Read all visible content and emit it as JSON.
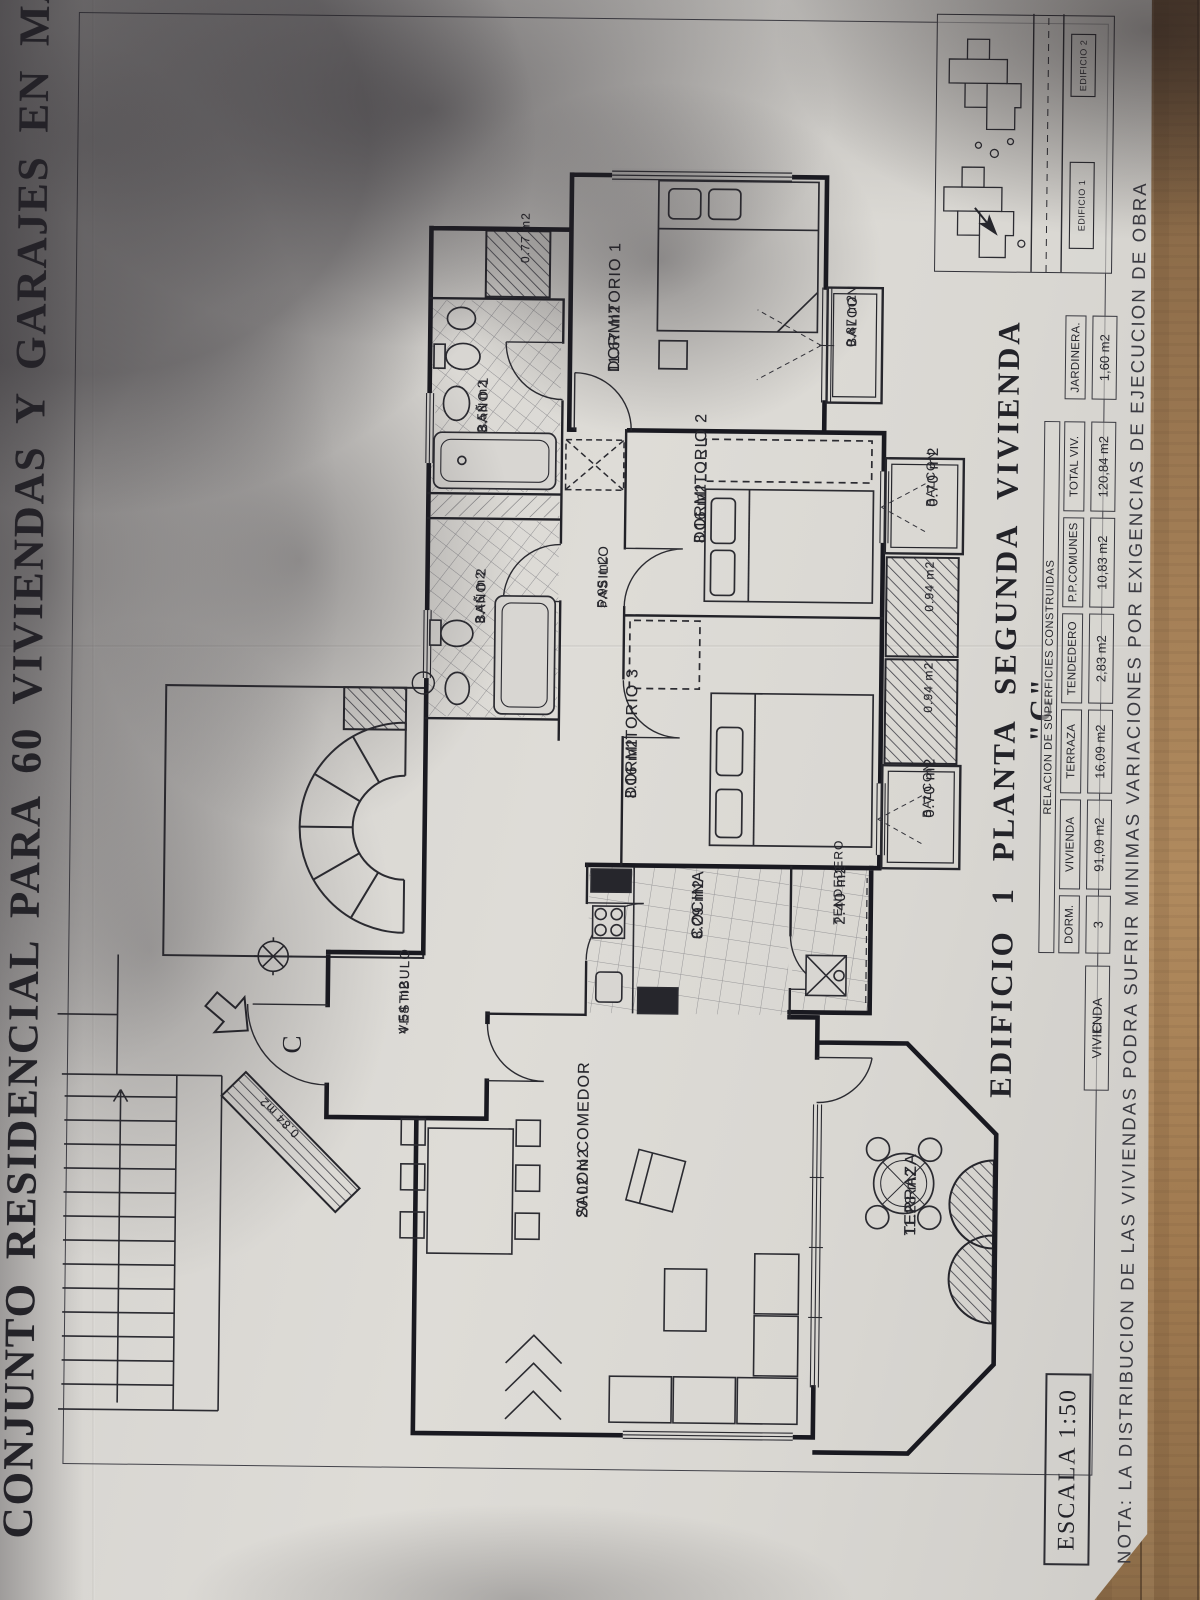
{
  "title": "CONJUNTO RESIDENCIAL PARA 60 VIVIENDAS Y GARAJES EN MARBELLA (M",
  "plan_title": "EDIFICIO 1 PLANTA SEGUNDA VIVIENDA \"C\"",
  "escala": "ESCALA 1:50",
  "nota": "NOTA: LA DISTRIBUCION DE LAS VIVIENDAS PODRA SUFRIR MINIMAS VARIACIONES POR EXIGENCIAS DE EJECUCION DE OBRA",
  "unit_letter": "C",
  "rooms": [
    {
      "name": "DORMITORIO 1",
      "area": "11.67 m2"
    },
    {
      "name": "BALCON",
      "area": "0.87 m2"
    },
    {
      "name": "BAÑO 1",
      "area": "3.58 m2"
    },
    {
      "name": "BAÑO 2",
      "area": "3.46 m2"
    },
    {
      "name": "PASILLO",
      "area": "5.95 m2"
    },
    {
      "name": "DORMITORIO 2",
      "area": "8.16 m2"
    },
    {
      "name": "BALCON",
      "area": "0.70 m2"
    },
    {
      "name": "DORMITORIO 3",
      "area": "8.16 m2"
    },
    {
      "name": "BALCON",
      "area": "0.70 m2"
    },
    {
      "name": "COCINA",
      "area": "8.29 m2"
    },
    {
      "name": "TENDEDERO",
      "area": "2.40 m2"
    },
    {
      "name": "VESTIBULO",
      "area": "4.54 m2"
    },
    {
      "name": "SALON COMEDOR",
      "area": "20.02 m2"
    },
    {
      "name": "TERRAZA",
      "area": "11.28 m2"
    }
  ],
  "small_areas": {
    "shaft_077": "0.77 m2",
    "jardinera_a": "0.94 m2",
    "jardinera_b": "0.94 m2",
    "entry_planter": "0.84 m2"
  },
  "table": {
    "header": "RELACION DE SUPERFICIES CONSTRUIDAS",
    "row_label": "VIVIENDA",
    "row_letter": "C",
    "columns": [
      {
        "label": "DORM.",
        "value": "3"
      },
      {
        "label": "VIVIENDA",
        "value": "91,09 m2"
      },
      {
        "label": "TERRAZA",
        "value": "16,09 m2"
      },
      {
        "label": "TENDEDERO",
        "value": "2,83 m2"
      },
      {
        "label": "P.P.COMUNES",
        "value": "10,83 m2"
      },
      {
        "label": "TOTAL VIV.",
        "value": "120,84 m2"
      }
    ],
    "jardinera": {
      "label": "JARDINERA.",
      "value": "1,60 m2"
    }
  },
  "inset": {
    "edificio_1": "EDIFICIO 1",
    "edificio_2": "EDIFICIO 2"
  }
}
